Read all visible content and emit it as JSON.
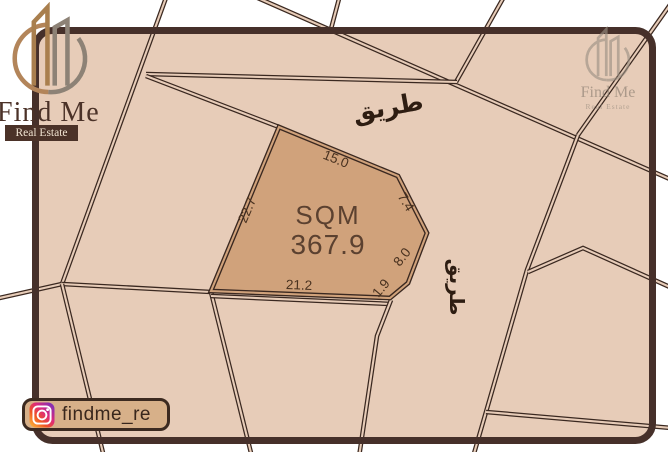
{
  "branding": {
    "logo_title": "Find Me",
    "logo_subtitle": "Real Estate",
    "watermark_title": "Find Me",
    "watermark_subtitle": "Real Estate",
    "instagram_handle": "findme_re"
  },
  "plot_info": {
    "area_label": "SQM",
    "area_value": "367.9"
  },
  "map": {
    "background": "#e7ccb8",
    "line_color": "#3a2820",
    "frame_color": "#46302a",
    "plot_fill": "#d0a27b",
    "frame": {
      "x": 35.5,
      "y": 30.5,
      "w": 617,
      "h": 410,
      "radius": 17,
      "thickness": 7
    },
    "plot_polygon": [
      [
        279,
        127
      ],
      [
        398,
        176
      ],
      [
        427,
        233
      ],
      [
        408,
        283
      ],
      [
        390,
        298
      ],
      [
        211,
        291
      ]
    ],
    "roads": [
      {
        "name": "left-steep-road",
        "points": [
          [
            167,
            -5
          ],
          [
            62,
            284
          ]
        ]
      },
      {
        "name": "left-exit-road",
        "points": [
          [
            62,
            284
          ],
          [
            -5,
            299
          ]
        ]
      },
      {
        "name": "junction-link-road",
        "points": [
          [
            62,
            284
          ],
          [
            211,
            292
          ]
        ]
      },
      {
        "name": "lower-left-road-a",
        "points": [
          [
            62,
            284
          ],
          [
            104,
            457
          ]
        ]
      },
      {
        "name": "lower-left-road-b",
        "points": [
          [
            211,
            292
          ],
          [
            252,
            457
          ]
        ]
      },
      {
        "name": "main-diagonal-road",
        "points": [
          [
            251,
            -5
          ],
          [
            672,
            180
          ]
        ]
      },
      {
        "name": "top-branch-a",
        "points": [
          [
            456,
            82
          ],
          [
            505,
            -5
          ]
        ]
      },
      {
        "name": "top-branch-b",
        "points": [
          [
            340,
            -5
          ],
          [
            331,
            29
          ]
        ]
      },
      {
        "name": "band-upper-left-edge",
        "points": [
          [
            146,
            74
          ],
          [
            457,
            82
          ]
        ]
      },
      {
        "name": "band-lower-left-edge",
        "points": [
          [
            146,
            76
          ],
          [
            279,
            127
          ]
        ]
      },
      {
        "name": "corner-branch-road",
        "points": [
          [
            578,
            135
          ],
          [
            672,
            2
          ]
        ]
      },
      {
        "name": "right-vertical-road",
        "points": [
          [
            578,
            135
          ],
          [
            527,
            270
          ],
          [
            486,
            412
          ],
          [
            473,
            457
          ]
        ]
      },
      {
        "name": "peak-parcel-edge",
        "points": [
          [
            528,
            272
          ],
          [
            583,
            248
          ],
          [
            672,
            288
          ]
        ]
      },
      {
        "name": "bottom-right-road",
        "points": [
          [
            486,
            412
          ],
          [
            672,
            428
          ]
        ]
      },
      {
        "name": "below-plot-road",
        "points": [
          [
            211,
            296
          ],
          [
            391,
            304
          ]
        ]
      },
      {
        "name": "plot-right-continuation",
        "points": [
          [
            391,
            300
          ],
          [
            377,
            336
          ],
          [
            359,
            457
          ]
        ]
      }
    ],
    "dimension_labels": [
      {
        "text": "15.0",
        "x": 336,
        "y": 159,
        "rot": 22
      },
      {
        "text": "22.7",
        "x": 247,
        "y": 210,
        "rot": -67
      },
      {
        "text": "21.2",
        "x": 299,
        "y": 285,
        "rot": 2
      },
      {
        "text": "7.4",
        "x": 406,
        "y": 202,
        "rot": 58
      },
      {
        "text": "8.0",
        "x": 402,
        "y": 257,
        "rot": -52
      },
      {
        "text": "1.9",
        "x": 381,
        "y": 288,
        "rot": -50
      }
    ],
    "road_labels": [
      {
        "text": "طريق",
        "x": 388,
        "y": 107,
        "rot": -10,
        "size": 25
      },
      {
        "text": "طريق",
        "x": 457,
        "y": 287,
        "rot": 90,
        "size": 20
      }
    ]
  }
}
